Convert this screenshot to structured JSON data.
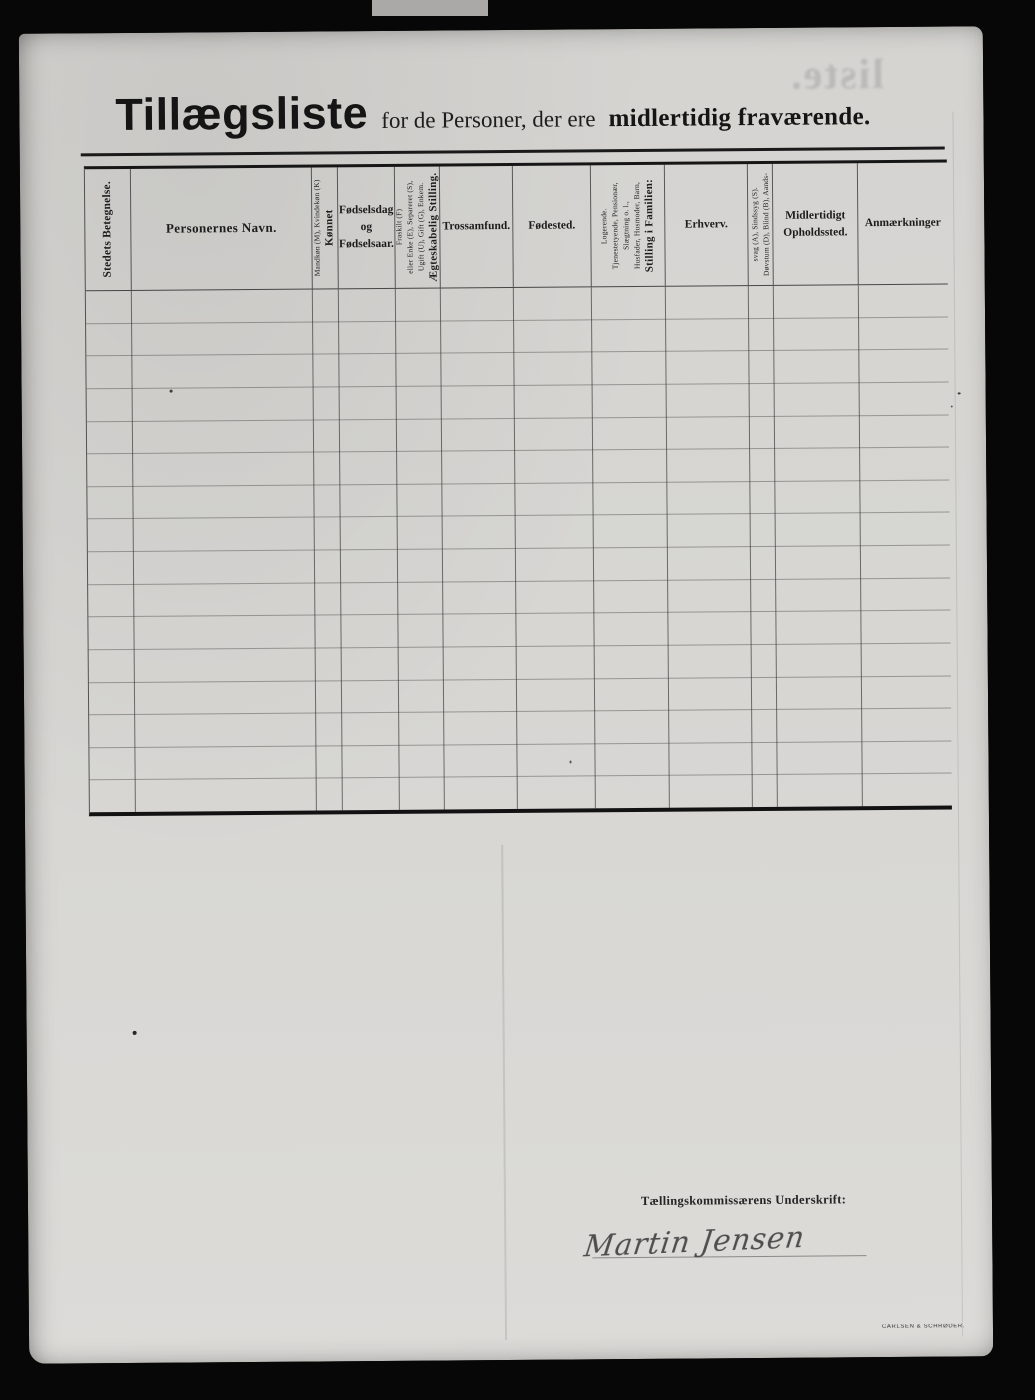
{
  "title": {
    "main": "Tillægsliste",
    "middle": "for de Personer, der ere",
    "emphasis": "midlertidig fraværende."
  },
  "bleedthrough": "liste.",
  "table": {
    "row_count": 16,
    "columns": [
      {
        "id": "stedets-betegnelse",
        "vertical": true,
        "bold_first": true,
        "lines": [
          "Stedets Betegnelse."
        ]
      },
      {
        "id": "personernes-navn",
        "vertical": false,
        "label": "Personernes Navn."
      },
      {
        "id": "koennet",
        "vertical": true,
        "bold_first": true,
        "lines": [
          "Kønnet",
          "Mandkøn (M), Kvindekøn (K)"
        ]
      },
      {
        "id": "foedselsdag-og-foedselsaar",
        "vertical": false,
        "label": "Fødselsdag og Fødselsaar."
      },
      {
        "id": "aegteskabelig-stilling",
        "vertical": true,
        "bold_first": true,
        "lines": [
          "Ægteskabelig Stilling.",
          "Ugift (U), Gift (G), Enkem.",
          "eller Enke (E), Separeret (S),",
          "Fraskilt (F)"
        ]
      },
      {
        "id": "trossamfund",
        "vertical": false,
        "label": "Trossamfund."
      },
      {
        "id": "foedested",
        "vertical": false,
        "label": "Fødested."
      },
      {
        "id": "stilling-i-familien",
        "vertical": true,
        "bold_first": true,
        "lines": [
          "Stilling i Familien:",
          "Husfader, Husmoder, Barn,",
          "Slægtning o. l.,",
          "Tjenestetyende, Pensionær,",
          "Logerende."
        ]
      },
      {
        "id": "erhverv",
        "vertical": false,
        "label": "Erhverv."
      },
      {
        "id": "doevstum-blind-aandssvag-sindssyg",
        "vertical": true,
        "bold_first": false,
        "lines": [
          "Døvstum (D), Blind (B), Aands-",
          "svag (A), Sindssyg (S)."
        ]
      },
      {
        "id": "midlertidigt-opholdssted",
        "vertical": false,
        "label": "Midlertidigt Opholdssted."
      },
      {
        "id": "anmaerkninger",
        "vertical": false,
        "label": "Anmærkninger"
      }
    ]
  },
  "signature": {
    "label": "Tællingskommissærens Underskrift:",
    "name": "Martin Jensen"
  },
  "printer_mark": "CARLSEN & SCHRØDER.",
  "colors": {
    "paper": "#d7d6d3",
    "ink": "#1b1b1b",
    "background": "#070707"
  }
}
